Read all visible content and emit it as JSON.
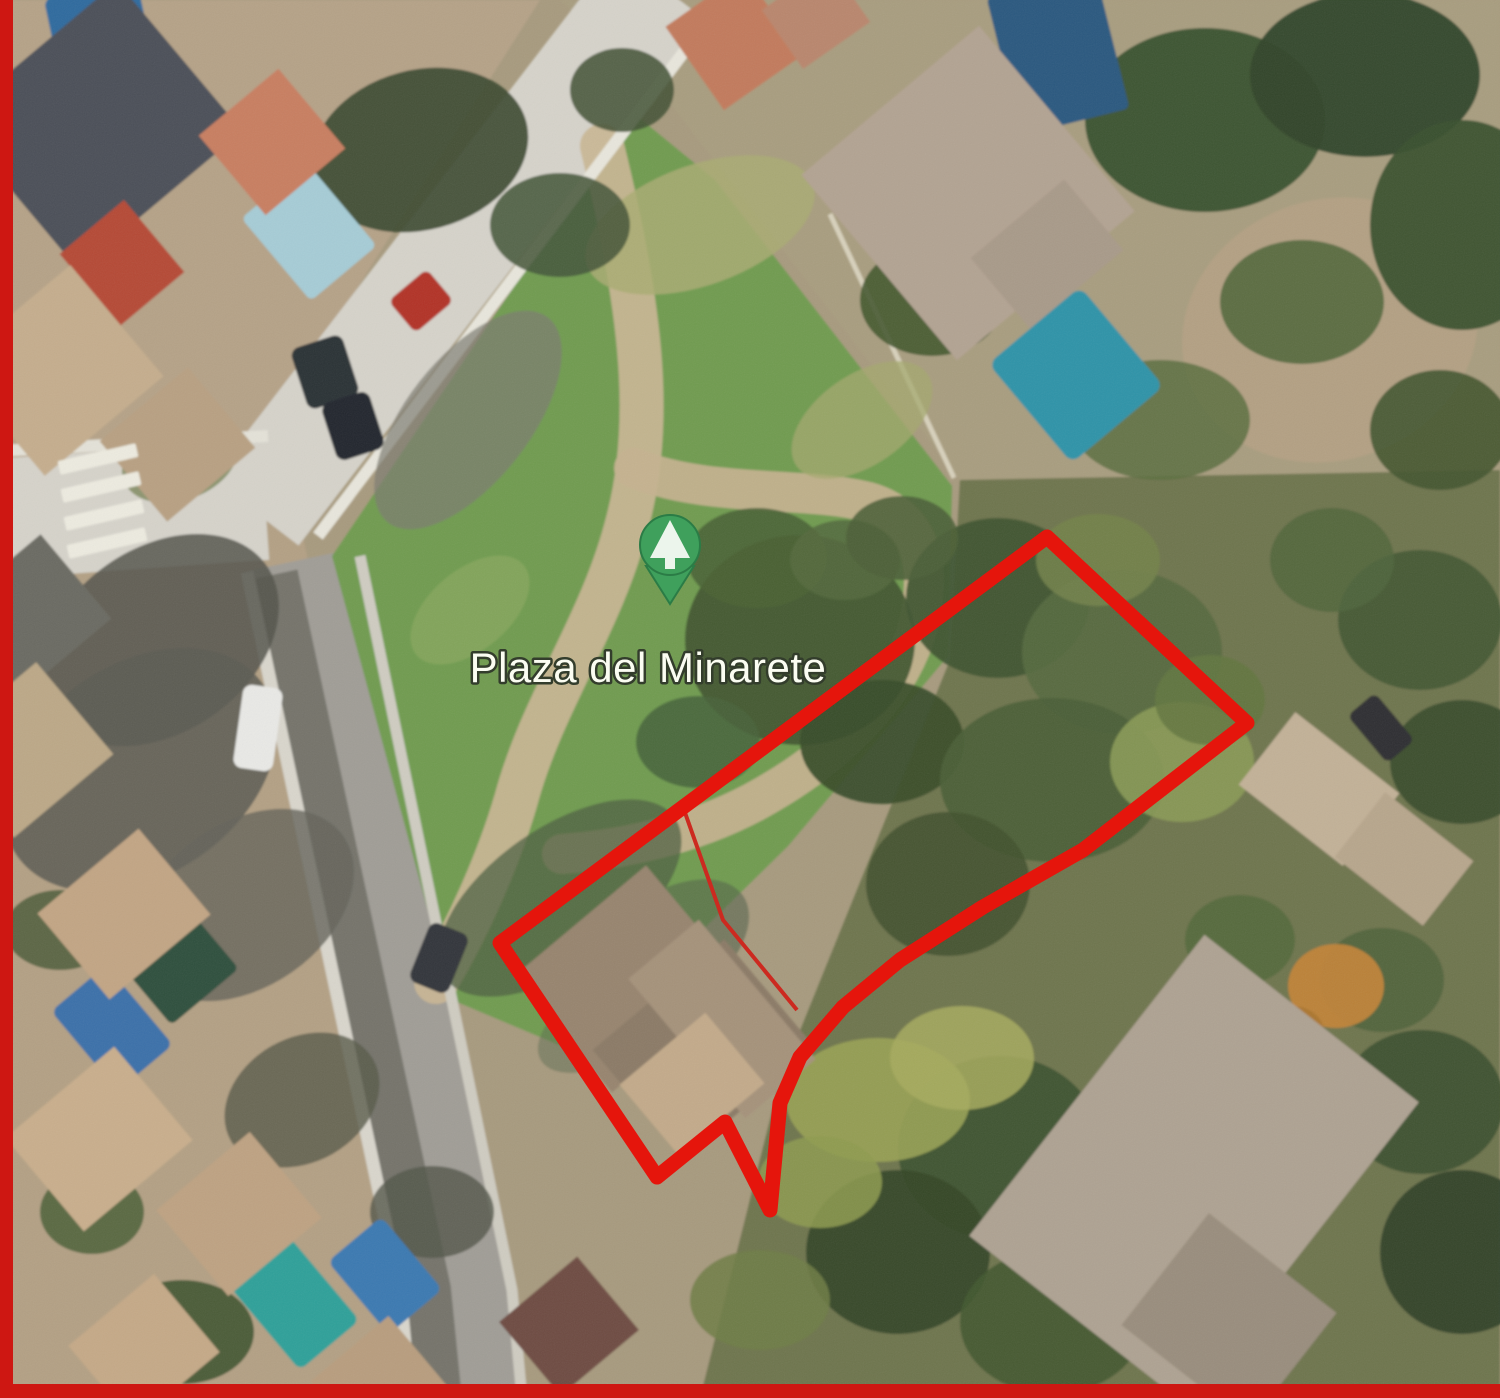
{
  "title": "Aerial satellite view with land plot boundary",
  "frame": {
    "color": "#ce1712",
    "left_width": 13,
    "bottom_height": 14
  },
  "map": {
    "base_color": "#a79a7e",
    "label": {
      "text": "Plaza del Minarete",
      "x": 648,
      "y": 682,
      "font_size": 42,
      "fill": "#fbfdf2",
      "stroke": "#333d2c",
      "stroke_width": 5
    },
    "pin": {
      "icon": "tree",
      "cx": 670,
      "cy": 545,
      "r": 30,
      "tip": "646,566 694,566 670,604",
      "tree_points": "670,520 650,558 690,558",
      "trunk": {
        "x": 665,
        "y": 558,
        "w": 10,
        "h": 11
      },
      "fill": "#3fa05c",
      "stroke": "#2b7c46",
      "icon_color": "#ecf5ec"
    },
    "boundary": {
      "color": "#e5150c",
      "width": 15,
      "outer_points": "1047,537 1247,723 1083,850 983,907 900,960 843,1007 800,1057 780,1103 770,1210 725,1122 657,1177 500,943",
      "inner_color": "#cc2a20",
      "inner_line_points": "683,807 723,920 797,1010",
      "inner_line_width": 4
    }
  },
  "scene": {
    "grounds": [
      {
        "points": "0,0 540,0 210,520 0,520",
        "c": "#b5a287",
        "t": "residential-block"
      },
      {
        "points": "560,0 1500,0 1500,470 960,480 660,90",
        "c": "#a89d7f",
        "t": "residential-block"
      },
      {
        "points": "300,500 700,500 760,1398 380,1398",
        "c": "#a79a7e",
        "t": "ground"
      },
      {
        "points": "960,480 1500,470 1500,1398 700,1398 780,1080 950,660",
        "c": "#6e744e",
        "t": "garden"
      },
      {
        "points": "0,520 300,520 470,1398 0,1398",
        "c": "#b3a084",
        "t": "residential-block"
      }
    ],
    "roads": [
      {
        "d": "M -20,520 L 265,500",
        "w": 120,
        "c": "#d6d3ca",
        "t": "road"
      },
      {
        "d": "M 255,512 L 660,-15",
        "w": 110,
        "c": "#d6d3ca",
        "t": "road"
      },
      {
        "d": "M 300,560 L 455,1290 L 468,1420",
        "w": 116,
        "c": "#a09d96",
        "t": "street"
      },
      {
        "d": "M 272,575 L 425,1290 L 438,1420",
        "w": 52,
        "c": "#75736b",
        "t": "street-shadow"
      }
    ],
    "grass": {
      "points": "332,556 632,112 715,180 952,486 948,656 788,846 625,1006 566,1048 452,1000",
      "c": "#6f9b4f"
    },
    "dirt_paths": [
      {
        "d": "M 602,146 C 645,320 652,428 628,520 C 603,622 542,702 516,800 C 499,858 470,925 436,982",
        "w": 44,
        "c": "#c9b694"
      },
      {
        "d": "M 634,468 C 708,498 806,486 868,502 C 918,516 934,562 918,626 C 898,700 828,762 754,802 C 690,836 618,850 562,854",
        "w": 40,
        "c": "#c5b28f"
      }
    ],
    "lines": [
      {
        "d": "M 318,536 L 702,28",
        "w": 12,
        "c": "#e8e6dc",
        "t": "sidewalk"
      },
      {
        "d": "M -20,452 L 268,436",
        "w": 12,
        "c": "#e4e2d8",
        "t": "sidewalk"
      },
      {
        "d": "M 247,572 L 400,1290 L 412,1420",
        "w": 13,
        "c": "#d9d6cc",
        "t": "sidewalk"
      },
      {
        "d": "M 360,556 L 512,1290 L 524,1420",
        "w": 11,
        "c": "#cfccc1",
        "t": "sidewalk"
      },
      {
        "d": "M 830,214 L 954,478",
        "w": 5,
        "c": "#d8d1bc",
        "t": "fence"
      }
    ],
    "patches": [
      [
        700,
        225,
        120,
        60,
        -20,
        "#a9ac72",
        0.85,
        "worn-grass"
      ],
      [
        862,
        420,
        80,
        45,
        -35,
        "#a4a86e",
        0.75,
        "worn-grass"
      ],
      [
        470,
        610,
        70,
        40,
        -40,
        "#8faa62",
        0.6,
        "worn-grass"
      ],
      [
        800,
        640,
        115,
        105,
        0,
        "#41562f",
        0.95,
        "tree"
      ],
      [
        757,
        558,
        70,
        50,
        0,
        "#4a6234",
        0.9,
        "tree"
      ],
      [
        882,
        742,
        82,
        62,
        0,
        "#394d2a",
        0.95,
        "tree"
      ],
      [
        698,
        742,
        62,
        46,
        0,
        "#46613a",
        0.85,
        "tree"
      ],
      [
        845,
        560,
        55,
        40,
        0,
        "#53683c",
        0.85,
        "tree"
      ],
      [
        560,
        898,
        140,
        70,
        -35,
        "#4e5f40",
        0.75,
        "shadow"
      ],
      [
        665,
        950,
        95,
        55,
        -35,
        "#55644b",
        0.6,
        "shadow"
      ],
      [
        610,
        1020,
        80,
        40,
        -30,
        "#5d6b4f",
        0.5,
        "shadow"
      ],
      [
        998,
        598,
        92,
        80,
        0,
        "#3f5532",
        0.95,
        "tree"
      ],
      [
        1122,
        652,
        100,
        82,
        0,
        "#55693f",
        0.9,
        "tree"
      ],
      [
        1052,
        780,
        112,
        82,
        0,
        "#4a5e36",
        0.92,
        "tree"
      ],
      [
        948,
        884,
        82,
        72,
        0,
        "#42532f",
        0.92,
        "tree"
      ],
      [
        1182,
        762,
        72,
        60,
        0,
        "#8a9a55",
        0.9,
        "shrub"
      ],
      [
        1098,
        560,
        62,
        46,
        0,
        "#73834a",
        0.85,
        "shrub"
      ],
      [
        902,
        538,
        56,
        42,
        0,
        "#4c5f37",
        0.9,
        "tree"
      ],
      [
        1210,
        700,
        55,
        45,
        0,
        "#62753f",
        0.85,
        "tree"
      ],
      [
        1330,
        330,
        150,
        130,
        -20,
        "#b3a083",
        1,
        "dirt-clearing"
      ],
      [
        1205,
        120,
        120,
        92,
        0,
        "#38512f",
        0.95,
        "tree"
      ],
      [
        1365,
        75,
        115,
        82,
        0,
        "#2f4429",
        0.95,
        "tree"
      ],
      [
        1462,
        225,
        92,
        105,
        0,
        "#3a512e",
        0.95,
        "tree"
      ],
      [
        1302,
        302,
        82,
        62,
        0,
        "#4c6438",
        0.85,
        "tree"
      ],
      [
        932,
        300,
        72,
        56,
        0,
        "#44582f",
        0.9,
        "tree"
      ],
      [
        1032,
        228,
        62,
        42,
        0,
        "#50683c",
        0.85,
        "tree"
      ],
      [
        1160,
        420,
        90,
        60,
        0,
        "#5a6e40",
        0.85,
        "tree"
      ],
      [
        1440,
        430,
        70,
        60,
        0,
        "#42552f",
        0.9,
        "tree"
      ],
      [
        420,
        150,
        110,
        80,
        -15,
        "#3c4a30",
        0.92,
        "tree"
      ],
      [
        560,
        225,
        70,
        52,
        0,
        "#46573a",
        0.88,
        "tree"
      ],
      [
        622,
        90,
        52,
        42,
        0,
        "#3f4f33",
        0.85,
        "tree"
      ],
      [
        180,
        460,
        60,
        40,
        -20,
        "#6d7a4a",
        0.7,
        "shrub"
      ],
      [
        468,
        420,
        130,
        62,
        -52,
        "#7c7a71",
        0.7,
        "road-shadow"
      ],
      [
        160,
        640,
        130,
        92,
        -35,
        "#54534b",
        0.85,
        "building-shadow"
      ],
      [
        140,
        770,
        150,
        105,
        -35,
        "#5b5a52",
        0.85,
        "building-shadow"
      ],
      [
        245,
        905,
        120,
        82,
        -35,
        "#64635a",
        0.8,
        "building-shadow"
      ],
      [
        1420,
        620,
        82,
        70,
        0,
        "#415834",
        0.9,
        "tree"
      ],
      [
        1462,
        762,
        72,
        62,
        0,
        "#374b2c",
        0.9,
        "tree"
      ],
      [
        1332,
        560,
        62,
        52,
        0,
        "#50653c",
        0.85,
        "tree"
      ],
      [
        1000,
        1148,
        102,
        92,
        0,
        "#3c5231",
        0.92,
        "tree"
      ],
      [
        898,
        1252,
        92,
        82,
        0,
        "#344627",
        0.92,
        "tree"
      ],
      [
        1052,
        1322,
        92,
        72,
        0,
        "#42582f",
        0.9,
        "tree"
      ],
      [
        1422,
        1102,
        82,
        72,
        0,
        "#3a4f2e",
        0.9,
        "tree"
      ],
      [
        1462,
        1252,
        82,
        82,
        0,
        "#2f4126",
        0.92,
        "tree"
      ],
      [
        1382,
        980,
        62,
        52,
        0,
        "#4e6339",
        0.85,
        "tree"
      ],
      [
        1240,
        940,
        55,
        45,
        0,
        "#54683a",
        0.85,
        "tree"
      ],
      [
        878,
        1100,
        92,
        62,
        0,
        "#98a254",
        0.9,
        "shrub"
      ],
      [
        962,
        1058,
        72,
        52,
        0,
        "#a7ab5e",
        0.85,
        "shrub"
      ],
      [
        820,
        1182,
        62,
        46,
        0,
        "#8e9b50",
        0.85,
        "shrub"
      ],
      [
        760,
        1300,
        70,
        50,
        0,
        "#6f7d45",
        0.85,
        "shrub"
      ],
      [
        1336,
        986,
        48,
        42,
        0,
        "#c08338",
        0.95,
        "autumn-tree"
      ],
      [
        1292,
        1032,
        32,
        26,
        0,
        "#a9742f",
        0.9,
        "autumn-tree"
      ],
      [
        302,
        1100,
        82,
        62,
        -30,
        "#585a4a",
        0.8,
        "shadow"
      ],
      [
        182,
        1332,
        72,
        52,
        0,
        "#3f5430",
        0.9,
        "tree"
      ],
      [
        92,
        1212,
        52,
        42,
        0,
        "#4a5f36",
        0.85,
        "tree"
      ],
      [
        432,
        1212,
        62,
        46,
        0,
        "#53564a",
        0.8,
        "shadow"
      ],
      [
        60,
        930,
        55,
        40,
        0,
        "#4c5c38",
        0.85,
        "tree"
      ]
    ],
    "rects": [
      [
        55,
        -12,
        95,
        118,
        -12,
        "#2d6a9e",
        8,
        "pool"
      ],
      [
        266,
        178,
        86,
        108,
        -40,
        "#a6ccd6",
        6,
        "pool"
      ],
      [
        1002,
        -18,
        112,
        142,
        -14,
        "#29587f",
        6,
        "pool-cover"
      ],
      [
        1016,
        310,
        120,
        130,
        -40,
        "#2f93a8",
        10,
        "pool"
      ],
      [
        136,
        928,
        88,
        78,
        -40,
        "#2e4f3e",
        6,
        "pool-cover"
      ],
      [
        76,
        976,
        72,
        104,
        -40,
        "#3a70a9",
        8,
        "pool"
      ],
      [
        256,
        1250,
        78,
        108,
        -40,
        "#2fa099",
        8,
        "pool"
      ],
      [
        350,
        1228,
        70,
        95,
        -40,
        "#3a79b1",
        8,
        "pool"
      ],
      [
        -10,
        28,
        215,
        195,
        -40,
        "#4b5058",
        0,
        "roof"
      ],
      [
        220,
        90,
        104,
        104,
        -40,
        "#c87e60",
        0,
        "roof"
      ],
      [
        80,
        216,
        84,
        94,
        -40,
        "#b54a36",
        0,
        "roof"
      ],
      [
        -20,
        298,
        155,
        145,
        -40,
        "#c5ad8d",
        0,
        "roof"
      ],
      [
        120,
        392,
        115,
        105,
        -40,
        "#b8a082",
        0,
        "roof"
      ],
      [
        686,
        -10,
        96,
        102,
        -35,
        "#c27a5c",
        0,
        "roof"
      ],
      [
        775,
        -20,
        82,
        72,
        -35,
        "#b9866d",
        0,
        "roof"
      ],
      [
        852,
        72,
        232,
        242,
        -40,
        "#b2a392",
        0,
        "roof"
      ],
      [
        986,
        208,
        122,
        92,
        -40,
        "#a89a89",
        0,
        "roof"
      ],
      [
        543,
        903,
        172,
        152,
        -40,
        "#97846e",
        0,
        "roof"
      ],
      [
        618,
        978,
        172,
        142,
        -40,
        "#8b7a66",
        0,
        "roof"
      ],
      [
        676,
        928,
        92,
        182,
        -40,
        "#a5927a",
        0,
        "roof"
      ],
      [
        636,
        1038,
        112,
        92,
        -40,
        "#c3aa8a",
        0,
        "courtyard"
      ],
      [
        58,
        858,
        132,
        112,
        -40,
        "#c2a584",
        0,
        "roof"
      ],
      [
        28,
        1078,
        142,
        122,
        -40,
        "#c9ae8c",
        0,
        "roof"
      ],
      [
        178,
        1158,
        122,
        112,
        -40,
        "#bea282",
        0,
        "roof"
      ],
      [
        88,
        1298,
        112,
        102,
        -40,
        "#c5a987",
        0,
        "roof"
      ],
      [
        328,
        1338,
        102,
        92,
        -40,
        "#b89d7e",
        0,
        "roof"
      ],
      [
        518,
        1278,
        102,
        96,
        -40,
        "#6e4c42",
        0,
        "roof"
      ],
      [
        -30,
        560,
        120,
        110,
        -40,
        "#6b6a62",
        0,
        "roof"
      ],
      [
        -40,
        690,
        130,
        120,
        -40,
        "#bca887",
        0,
        "roof"
      ],
      [
        1058,
        978,
        272,
        382,
        38,
        "#aea292",
        0,
        "roof"
      ],
      [
        1148,
        1248,
        162,
        142,
        38,
        "#998d7d",
        0,
        "roof"
      ],
      [
        1253,
        743,
        132,
        92,
        38,
        "#c2b197",
        0,
        "roof"
      ],
      [
        1348,
        818,
        112,
        82,
        38,
        "#b7a68c",
        0,
        "roof"
      ],
      [
        396,
        280,
        50,
        42,
        -40,
        "#b23325",
        7,
        "car-red"
      ],
      [
        298,
        340,
        54,
        64,
        -18,
        "#2b3036",
        9,
        "car"
      ],
      [
        328,
        396,
        50,
        60,
        -18,
        "#23282e",
        9,
        "car"
      ],
      [
        238,
        686,
        40,
        84,
        8,
        "#e9e9e6",
        9,
        "car-white"
      ],
      [
        418,
        926,
        42,
        64,
        22,
        "#33363a",
        9,
        "car"
      ],
      [
        1350,
        710,
        62,
        36,
        50,
        "#2e2f30",
        7,
        "car"
      ],
      [
        58,
        452,
        80,
        14,
        -13,
        "#edebe0",
        2,
        "crosswalk-stripe"
      ],
      [
        61,
        480,
        80,
        14,
        -13,
        "#edebe0",
        2,
        "crosswalk-stripe"
      ],
      [
        64,
        508,
        80,
        14,
        -13,
        "#edebe0",
        2,
        "crosswalk-stripe"
      ],
      [
        67,
        536,
        80,
        14,
        -13,
        "#edebe0",
        2,
        "crosswalk-stripe"
      ]
    ]
  }
}
